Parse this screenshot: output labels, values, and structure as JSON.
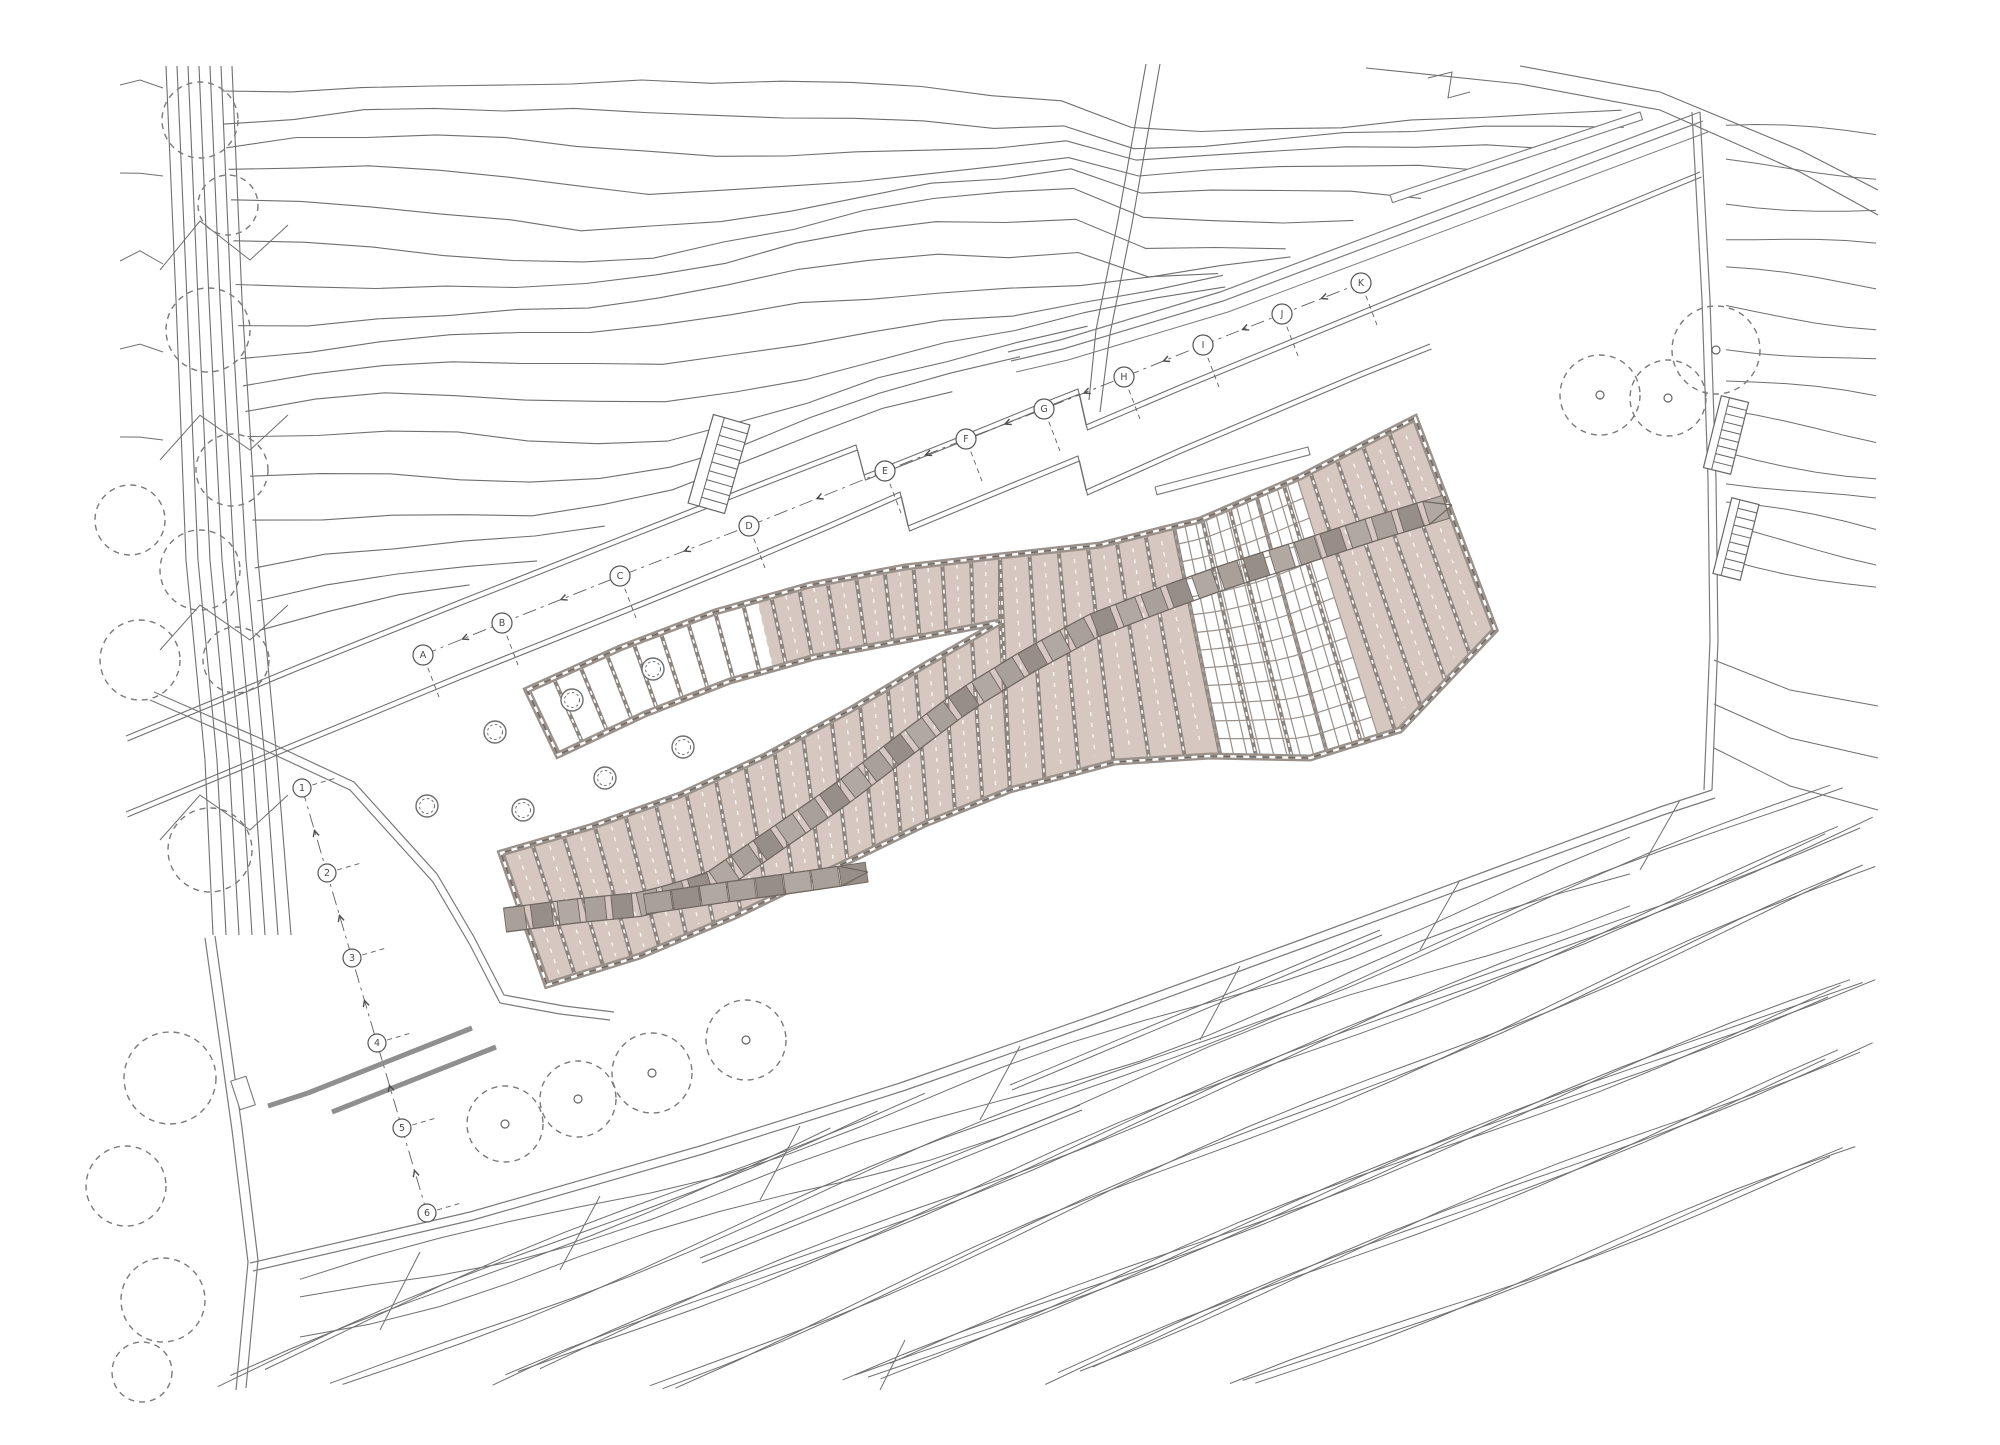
{
  "canvas": {
    "width": 2000,
    "height": 1445,
    "background": "#ffffff"
  },
  "colors": {
    "contour": "#6f6f6f",
    "boundary": "#7a7a7a",
    "deck_fill": "#d6c8c0",
    "plank_divider": "#8d847e",
    "rail": "#9a918b",
    "rail_dark": "#6b635d",
    "walkway_a": "#a8a099",
    "walkway_b": "#978e88",
    "walkway_c": "#b0a8a1",
    "walkway_edge": "#6e665f",
    "grid_line": "#9a918b",
    "tree": "#7a7a7a",
    "gray_wall": "#8f8f8f",
    "marker_text": "#4a4a4a"
  },
  "deck": {
    "branch_top_left": [
      [
        527,
        690
      ],
      [
        620,
        648
      ],
      [
        715,
        612
      ],
      [
        810,
        585
      ],
      [
        905,
        567
      ],
      [
        1000,
        556
      ]
    ],
    "top_right": [
      [
        1000,
        556
      ],
      [
        1100,
        545
      ],
      [
        1200,
        520
      ],
      [
        1300,
        477
      ],
      [
        1415,
        418
      ]
    ],
    "branch_bottom_left": [
      [
        558,
        755
      ],
      [
        645,
        714
      ],
      [
        730,
        681
      ],
      [
        815,
        657
      ],
      [
        900,
        641
      ],
      [
        1000,
        622
      ]
    ],
    "main_top_left": [
      [
        501,
        853
      ],
      [
        590,
        827
      ],
      [
        680,
        795
      ],
      [
        765,
        756
      ],
      [
        850,
        710
      ],
      [
        925,
        665
      ],
      [
        1000,
        622
      ]
    ],
    "main_bottom_left": [
      [
        547,
        985
      ],
      [
        640,
        956
      ],
      [
        735,
        916
      ],
      [
        830,
        870
      ],
      [
        925,
        824
      ],
      [
        1010,
        790
      ]
    ],
    "bottom_right": [
      [
        1010,
        790
      ],
      [
        1115,
        762
      ],
      [
        1210,
        756
      ],
      [
        1310,
        758
      ],
      [
        1400,
        730
      ],
      [
        1495,
        630
      ]
    ],
    "right_cap_end": [
      1495,
      630
    ],
    "planks": {
      "branch": 17,
      "main": 17,
      "right": 15
    },
    "white_branch_t": [
      0,
      0.5
    ],
    "grid_t": [
      0.4,
      0.7
    ],
    "grid_mesh": [
      12,
      13
    ]
  },
  "walkway": {
    "path": [
      [
        505,
        920
      ],
      [
        575,
        911
      ],
      [
        645,
        904
      ],
      [
        710,
        885
      ],
      [
        775,
        840
      ],
      [
        840,
        795
      ],
      [
        905,
        745
      ],
      [
        965,
        700
      ],
      [
        1030,
        660
      ],
      [
        1095,
        625
      ],
      [
        1160,
        600
      ],
      [
        1230,
        575
      ],
      [
        1300,
        553
      ],
      [
        1370,
        530
      ],
      [
        1452,
        505
      ]
    ],
    "stub": [
      [
        645,
        904
      ],
      [
        720,
        893
      ],
      [
        800,
        882
      ],
      [
        868,
        872
      ]
    ],
    "half_width": 12,
    "stub_half_width": 10,
    "seg_len": 27
  },
  "column_circles": [
    [
      572,
      700
    ],
    [
      653,
      669
    ],
    [
      495,
      732
    ],
    [
      523,
      810
    ],
    [
      605,
      778
    ],
    [
      683,
      747
    ],
    [
      427,
      806
    ]
  ],
  "trees_bottom": [
    [
      505,
      1124,
      38
    ],
    [
      578,
      1099,
      38
    ],
    [
      652,
      1073,
      40
    ],
    [
      746,
      1040,
      40
    ]
  ],
  "trees_topright": [
    [
      1600,
      395,
      40
    ],
    [
      1668,
      398,
      38
    ],
    [
      1716,
      350,
      44
    ]
  ],
  "trees_left": [
    [
      200,
      120,
      38
    ],
    [
      228,
      205,
      30
    ],
    [
      208,
      330,
      42
    ],
    [
      232,
      470,
      36
    ],
    [
      200,
      570,
      40
    ],
    [
      236,
      660,
      33
    ],
    [
      210,
      850,
      42
    ],
    [
      130,
      520,
      35
    ],
    [
      140,
      660,
      40
    ]
  ],
  "trees_bottomleft": [
    [
      170,
      1078,
      46
    ],
    [
      126,
      1186,
      40
    ],
    [
      163,
      1300,
      42
    ],
    [
      142,
      1372,
      30
    ]
  ],
  "survey_letters": [
    [
      "A",
      423,
      655
    ],
    [
      "B",
      502,
      623
    ],
    [
      "C",
      620,
      576
    ],
    [
      "D",
      749,
      526
    ],
    [
      "E",
      885,
      471
    ],
    [
      "F",
      966,
      439
    ],
    [
      "G",
      1044,
      409
    ],
    [
      "H",
      1124,
      377
    ],
    [
      "I",
      1203,
      345
    ],
    [
      "J",
      1282,
      314
    ],
    [
      "K",
      1361,
      283
    ]
  ],
  "survey_numbers": [
    [
      "1",
      302,
      788
    ],
    [
      "2",
      327,
      873
    ],
    [
      "3",
      352,
      958
    ],
    [
      "4",
      377,
      1043
    ],
    [
      "5",
      402,
      1128
    ],
    [
      "6",
      427,
      1213
    ]
  ],
  "ladders": {
    "main": {
      "x": 700,
      "y": 418,
      "w": 38,
      "h": 92,
      "rot": 16,
      "rungs": 9
    },
    "right": [
      {
        "x": 1712,
        "y": 398,
        "w": 28,
        "h": 74,
        "rot": 14,
        "rungs": 8
      },
      {
        "x": 1722,
        "y": 500,
        "w": 28,
        "h": 78,
        "rot": 14,
        "rungs": 8
      }
    ]
  },
  "paths": {
    "p1": [
      [
        126,
        736
      ],
      [
        300,
        664
      ],
      [
        460,
        600
      ],
      [
        620,
        537
      ],
      [
        770,
        478
      ],
      [
        856,
        445
      ],
      [
        864,
        475
      ],
      [
        952,
        440
      ],
      [
        1040,
        404
      ],
      [
        1078,
        389
      ],
      [
        1086,
        425
      ],
      [
        1180,
        385
      ],
      [
        1280,
        344
      ],
      [
        1380,
        303
      ],
      [
        1480,
        262
      ],
      [
        1600,
        213
      ],
      [
        1700,
        172
      ]
    ],
    "p2": [
      [
        126,
        812
      ],
      [
        300,
        740
      ],
      [
        460,
        674
      ],
      [
        620,
        610
      ],
      [
        750,
        557
      ],
      [
        830,
        523
      ],
      [
        900,
        492
      ],
      [
        908,
        526
      ],
      [
        1000,
        488
      ],
      [
        1078,
        456
      ],
      [
        1086,
        490
      ],
      [
        1180,
        448
      ],
      [
        1270,
        410
      ],
      [
        1360,
        372
      ],
      [
        1430,
        344
      ]
    ],
    "gap": 5
  },
  "boundaries": {
    "top": [
      [
        1700,
        112
      ],
      [
        1540,
        172
      ],
      [
        1380,
        232
      ],
      [
        1220,
        292
      ],
      [
        1060,
        340
      ],
      [
        1008,
        352
      ]
    ],
    "right": [
      [
        1700,
        112
      ],
      [
        1710,
        300
      ],
      [
        1716,
        480
      ],
      [
        1718,
        640
      ],
      [
        1712,
        790
      ]
    ],
    "south": [
      [
        1712,
        790
      ],
      [
        1660,
        807
      ],
      [
        1500,
        866
      ],
      [
        1300,
        940
      ],
      [
        1100,
        1013
      ],
      [
        900,
        1083
      ],
      [
        700,
        1146
      ],
      [
        470,
        1212
      ],
      [
        250,
        1263
      ]
    ],
    "road": [
      [
        205,
        938
      ],
      [
        232,
        1130
      ],
      [
        248,
        1262
      ],
      [
        236,
        1390
      ]
    ],
    "nw": [
      [
        150,
        700
      ],
      [
        260,
        748
      ],
      [
        350,
        790
      ],
      [
        433,
        882
      ],
      [
        470,
        945
      ],
      [
        500,
        1003
      ],
      [
        560,
        1014
      ],
      [
        610,
        1020
      ]
    ],
    "planter": [
      [
        1155,
        487
      ],
      [
        1308,
        447
      ]
    ],
    "strip_topright": [
      [
        1390,
        195
      ],
      [
        1640,
        112
      ]
    ],
    "road_tab": {
      "x": 228,
      "y": 1085,
      "w": 30,
      "h": 16,
      "rot": 72
    }
  },
  "gray_walls": [
    [
      [
        308,
        1093
      ],
      [
        472,
        1028
      ]
    ],
    [
      [
        332,
        1112
      ],
      [
        496,
        1047
      ]
    ],
    [
      [
        268,
        1106
      ],
      [
        308,
        1093
      ]
    ]
  ],
  "notch_walls": [
    [
      [
        1146,
        64
      ],
      [
        1118,
        220
      ],
      [
        1096,
        330
      ],
      [
        1089,
        400
      ]
    ],
    [
      [
        1160,
        64
      ],
      [
        1132,
        224
      ],
      [
        1110,
        334
      ],
      [
        1100,
        412
      ]
    ]
  ],
  "bundle_strips": [
    [
      [
        1010,
        1085
      ],
      [
        1380,
        930
      ]
    ],
    [
      [
        700,
        1258
      ],
      [
        1080,
        1105
      ]
    ]
  ],
  "bundle_connectors": [
    [
      380,
      1330,
      420,
      1252
    ],
    [
      560,
      1270,
      600,
      1196
    ],
    [
      760,
      1200,
      800,
      1126
    ],
    [
      980,
      1120,
      1020,
      1046
    ],
    [
      1200,
      1040,
      1240,
      966
    ],
    [
      1420,
      950,
      1460,
      880
    ],
    [
      880,
      1390,
      905,
      1340
    ],
    [
      1640,
      870,
      1680,
      800
    ]
  ],
  "contour_params": {
    "topleft": {
      "count": 17,
      "y0": 78,
      "dy": 34,
      "x_end": 1692,
      "step": 70,
      "wiggle": 13
    },
    "right": {
      "count": 14,
      "x0": 1726,
      "x1": 1878,
      "y0": 128,
      "dy": 36
    },
    "bundles": {
      "starts": [
        205,
        330,
        480,
        650,
        830,
        1020,
        1230
      ],
      "lines": [
        3,
        2,
        4,
        3,
        5,
        4,
        3
      ],
      "slope": -0.4,
      "spacing": 11
    },
    "south_waves": 3
  }
}
